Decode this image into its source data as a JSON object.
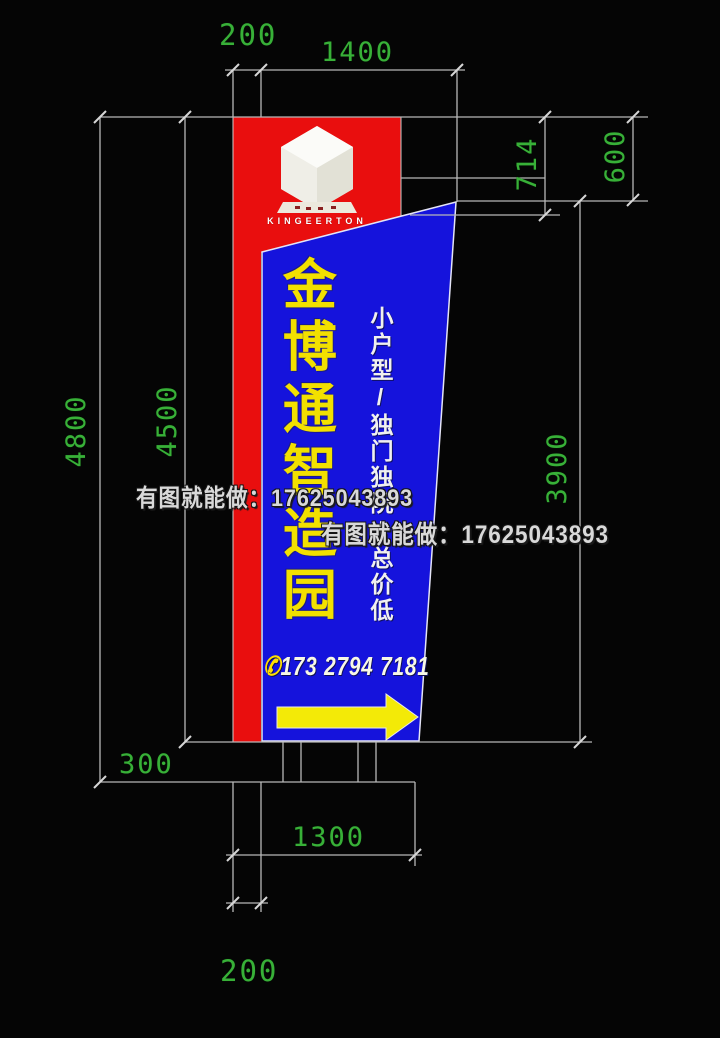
{
  "drawing_type": "signage pylon construction drawing",
  "sign": {
    "brand_text": "KINGEERTON",
    "main_text": "金博通智造园",
    "side_text": "小户型/独门独院/总价低",
    "phone_icon": "✆",
    "phone_number": "173 2794 7181"
  },
  "dimensions": {
    "column_width_top": "200",
    "panel_width": "1400",
    "header_depth_inner": "714",
    "header_depth_outer": "600",
    "total_height": "4800",
    "sign_height": "4500",
    "panel_height": "3900",
    "base_height": "300",
    "foundation_width": "1300",
    "column_width_bottom": "200"
  },
  "watermark": {
    "text": "有图就能做：17625043893"
  },
  "colors": {
    "background": "#050505",
    "column_red": "#e90e0e",
    "panel_blue": "#1513dc",
    "dim_green": "#38b038",
    "construction_line_gray": "#b8b8b8",
    "main_text_yellow": "#f2e000",
    "arrow_yellow": "#f3ea07",
    "watermark_gray": "#d9d9d9"
  }
}
